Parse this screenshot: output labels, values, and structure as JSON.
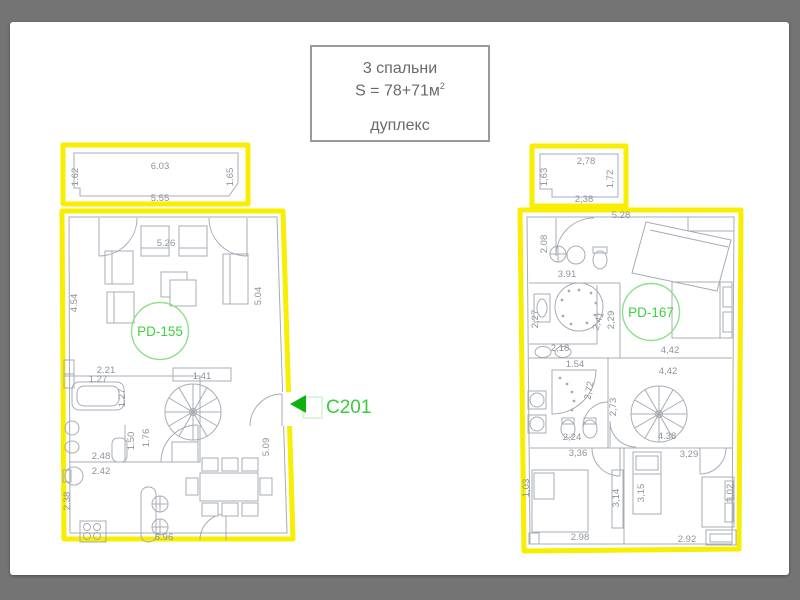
{
  "title_card": {
    "line1": "3 спальни",
    "line2": "S = 78+71м",
    "line2_sup": "2",
    "line3": "дуплекс"
  },
  "entrance": {
    "code": "C201"
  },
  "units": {
    "left": {
      "id": "PD-155",
      "balcony": {
        "top": "6.03",
        "left": "1.62",
        "right": "1.65",
        "bottom": "5.55"
      },
      "dims": {
        "top_wall": "5.26",
        "left_wall": "4.54",
        "right_wall": "5.04",
        "bath_top": "2.21",
        "niche": "1.41",
        "tub_length": "1.27",
        "tub_width": "1.27",
        "wc_width": "1.50",
        "hall_width": "1.76",
        "wc_depth": "2.48",
        "kitchen_width": "2.42",
        "kitchen_height": "2.38",
        "bottom_wall": "5.96",
        "right_wall_lower": "5.09"
      }
    },
    "right": {
      "id": "PD-167",
      "balcony": {
        "top": "2,78",
        "left": "1,63",
        "right": "1,72",
        "bottom": "2,38"
      },
      "dims": {
        "top_wall": "5.28",
        "entry_left": "2.08",
        "hall_top": "3.91",
        "bath1_left": "2,27",
        "bath1_diag": "2,41",
        "corridor": "2,29",
        "bedroom1_width": "4,42",
        "hall_mid": "4,42",
        "bath2_top": "1.54",
        "shower": "2,72",
        "stair_left": "2,73",
        "stair_width": "4.38",
        "sinks": "2,18",
        "wc": "2,24",
        "bedroom2_top": "3,36",
        "bedroom3_top": "3,29",
        "bedroom2_left": "1,03",
        "bedroom2_bottom": "2.98",
        "closet_height": "3,14",
        "bed3_height": "3,15",
        "bedroom3_right": "3,02",
        "bedroom3_bottom": "2.92"
      }
    }
  },
  "colors": {
    "page_frame": "#747474",
    "plan_outline_yellow": "#f7ee00",
    "unit_label_green": "#3ed13e",
    "entrance_arrow_green": "#10b012",
    "dimension_gray": "#8e939b",
    "wall_gray": "#a7acb4"
  }
}
